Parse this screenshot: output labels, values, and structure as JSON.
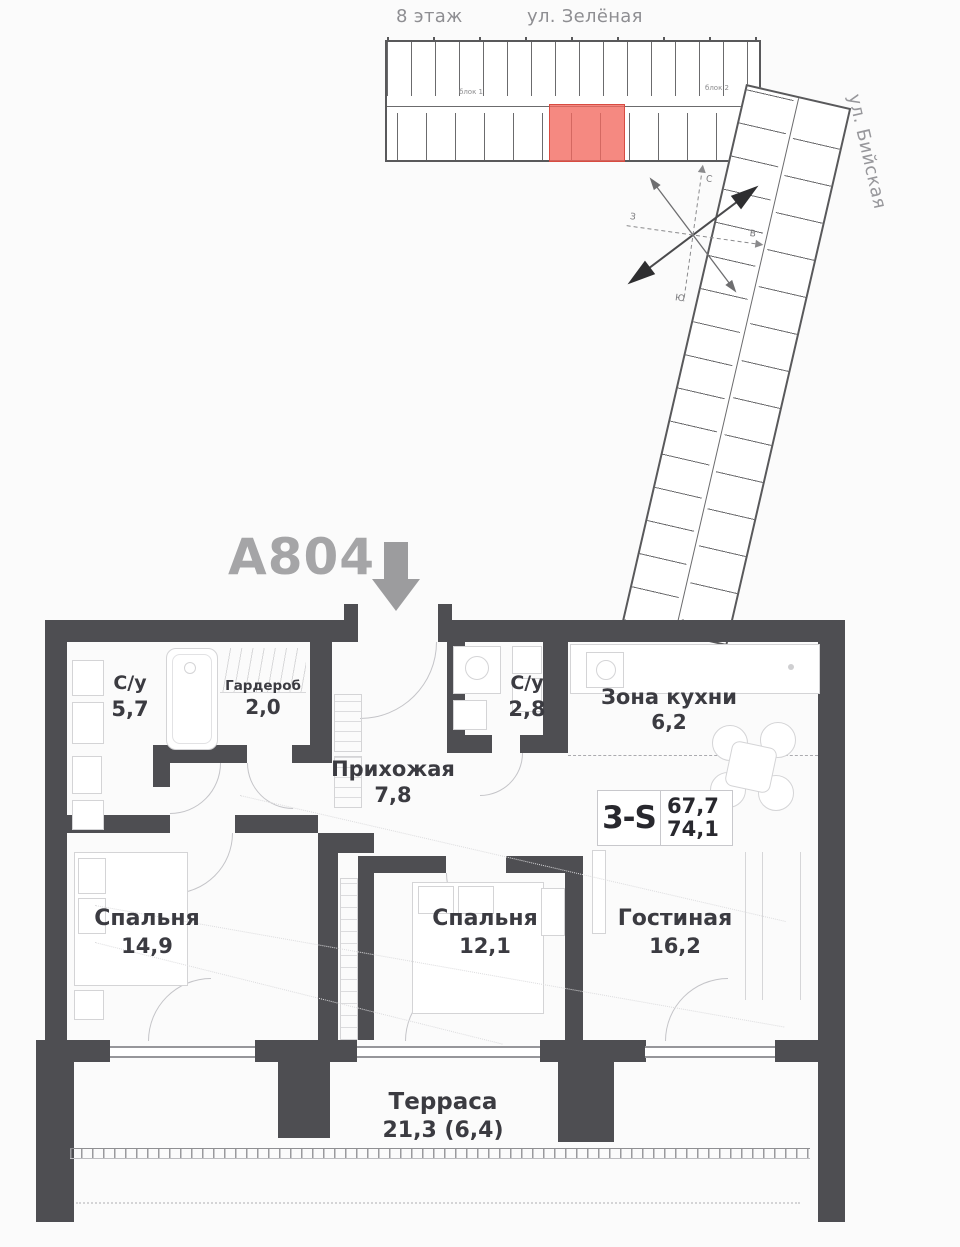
{
  "site_plan": {
    "floor_label": "8 этаж",
    "street_top": "ул. Зелёная",
    "street_side": "ул. Бийская",
    "block_labels": [
      "блок 1",
      "блок 2"
    ],
    "highlight_color": "#f2685e",
    "compass_letters": {
      "n": "С",
      "e": "В",
      "s": "Ю",
      "w": "З"
    }
  },
  "unit": {
    "code": "А804",
    "badge": {
      "type": "3-S",
      "area_living": "67,7",
      "area_total": "74,1"
    }
  },
  "rooms": {
    "bath1": {
      "name": "С/у",
      "area": "5,7"
    },
    "wardrobe": {
      "name": "Гардероб",
      "area": "2,0"
    },
    "hall": {
      "name": "Прихожая",
      "area": "7,8"
    },
    "bath2": {
      "name": "С/у",
      "area": "2,8"
    },
    "kitchen": {
      "name": "Зона кухни",
      "area": "6,2"
    },
    "bedroom1": {
      "name": "Спальня",
      "area": "14,9"
    },
    "bedroom2": {
      "name": "Спальня",
      "area": "12,1"
    },
    "living": {
      "name": "Гостиная",
      "area": "16,2"
    },
    "terrace": {
      "name": "Терраса",
      "area": "21,3 (6,4)"
    }
  }
}
